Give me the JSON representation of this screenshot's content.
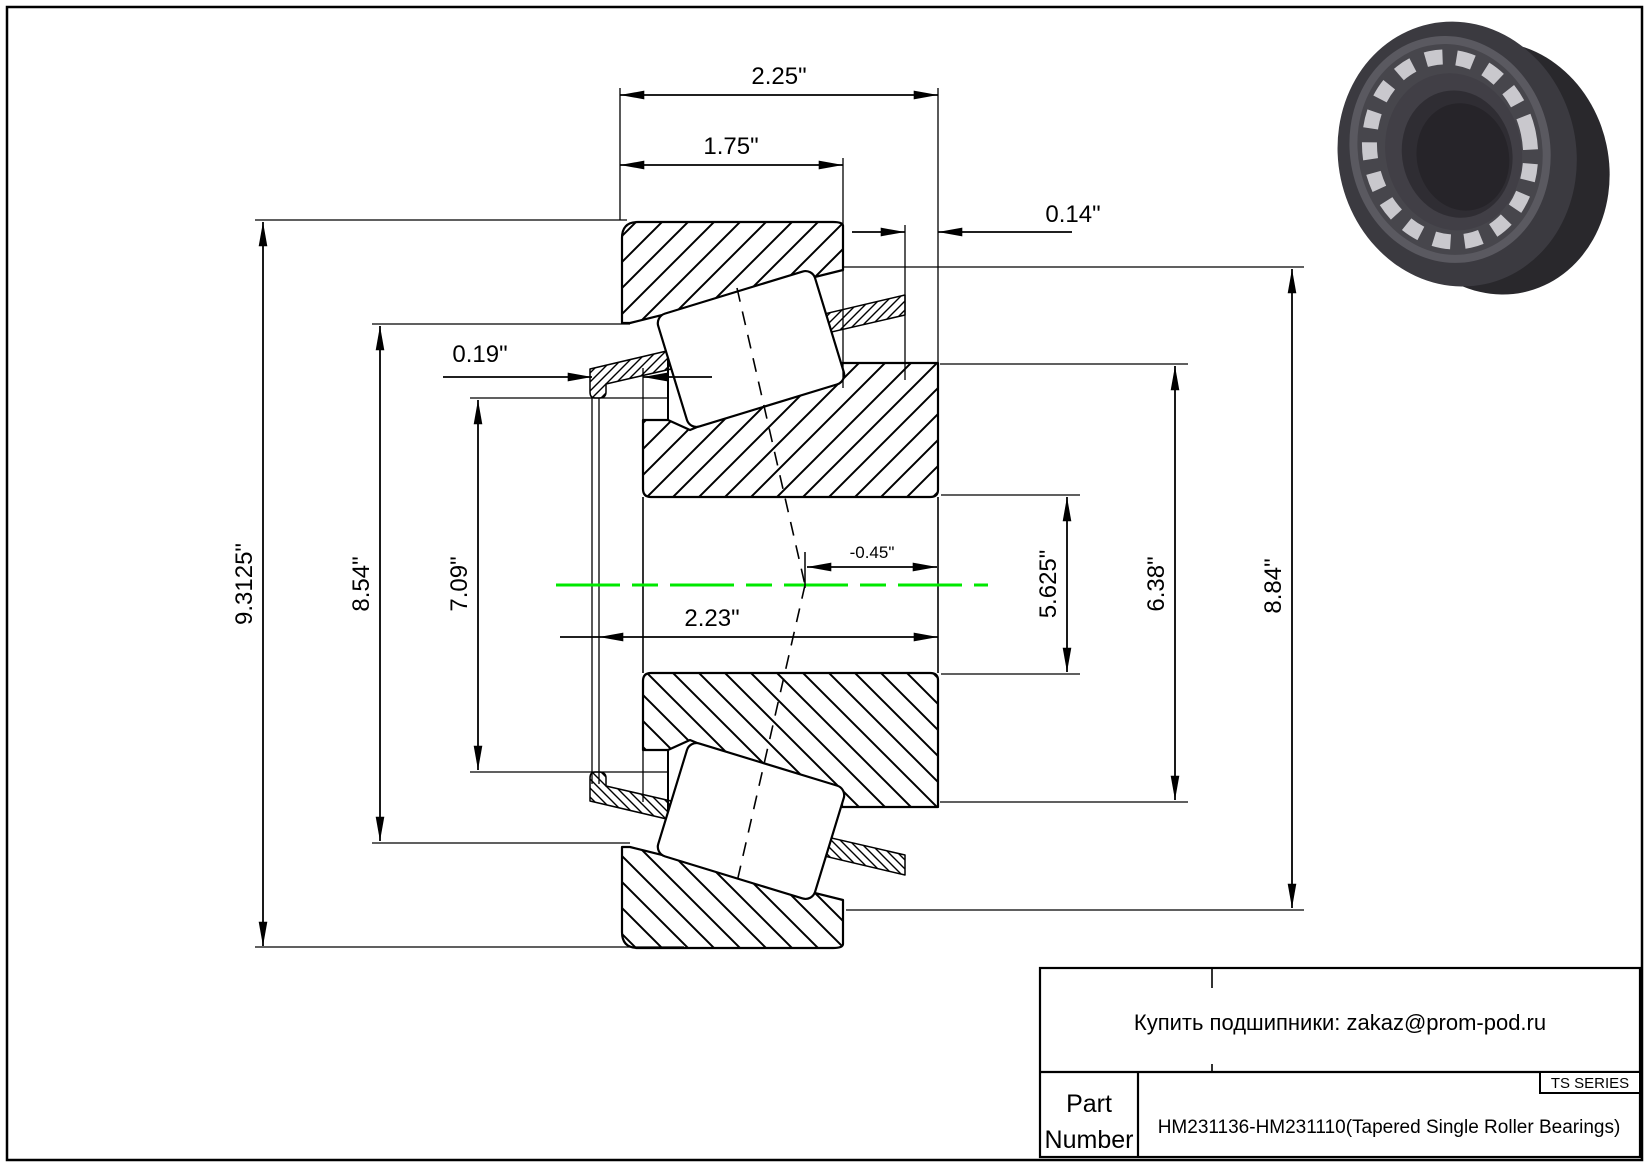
{
  "drawing": {
    "type": "Tapered single roller bearing cross-section drawing",
    "colors": {
      "line": "#000000",
      "centerline": "#00e800",
      "paper": "#ffffff"
    },
    "dimensions": {
      "total_width": "2.25\"",
      "cup_width": "1.75\"",
      "standout": "0.14\"",
      "cage_lip": "0.19\"",
      "cup_od": "9.3125\"",
      "cup_front_id": "8.54\"",
      "cone_rib_od": "7.09\"",
      "cone_width": "2.23\"",
      "effective_center": "-0.45\"",
      "bore": "5.625\"",
      "cone_back_rib_od": "6.38\"",
      "race_od": "8.84\""
    }
  },
  "title_block": {
    "contact": "Купить подшипники: zakaz@prom-pod.ru",
    "part_label_line1": "Part",
    "part_label_line2": "Number",
    "series": "TS SERIES",
    "part_number": "HM231136-HM231110(Tapered Single Roller Bearings)"
  }
}
